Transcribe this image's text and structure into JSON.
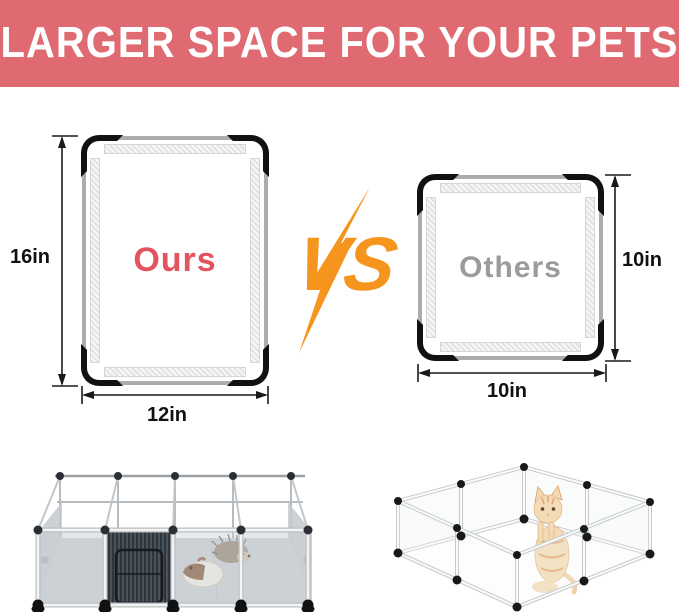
{
  "header": {
    "title": "LARGER SPACE FOR YOUR PETS",
    "bg_color": "#e06a72",
    "text_color": "#ffffff"
  },
  "comparison": {
    "ours": {
      "label": "Ours",
      "label_color": "#e4545f",
      "height_label": "16in",
      "width_label": "12in"
    },
    "vs": {
      "label": "VS",
      "color": "#f6951e"
    },
    "others": {
      "label": "Others",
      "label_color": "#9b9b9b",
      "height_label": "10in",
      "width_label": "10in"
    }
  },
  "illustrations": {
    "ours_photo": "large-playpen-with-wire-door-guinea-pig-and-hedgehog",
    "others_photo": "small-clear-playpen-with-kitten"
  },
  "colors": {
    "panel_border": "#a9adb0",
    "corner_black": "#111111",
    "dimension_text": "#111111"
  }
}
